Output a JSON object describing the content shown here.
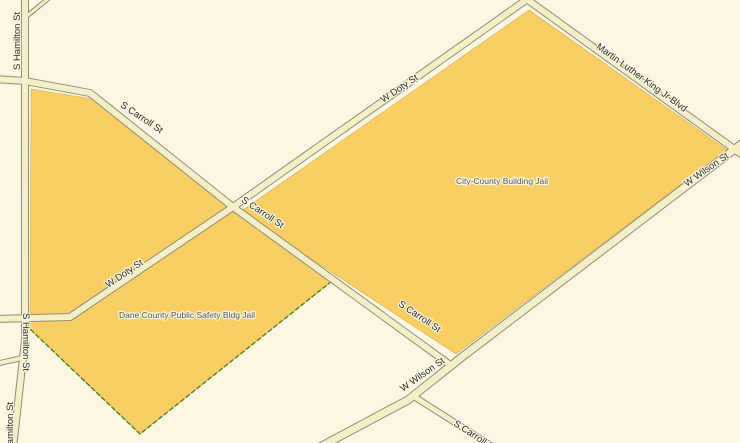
{
  "map": {
    "colors": {
      "background": "#FBF7E3",
      "street_fill": "#F4EFC6",
      "street_casing": "#8D8D7B",
      "parcel_fill": "#F9CE63",
      "parcel_dashed_border": "#4A8420",
      "street_label_color": "#2B2B28",
      "place_label_color": "#53544C"
    },
    "parcels": [
      {
        "name": "City-County Building Jail",
        "points": [
          [
            529,
            10
          ],
          [
            240,
            212
          ],
          [
            456,
            354
          ],
          [
            727,
            150
          ]
        ]
      },
      {
        "name": "Dane County Public Safety Bldg Jail",
        "points": [
          [
            31,
            89
          ],
          [
            93,
            99
          ],
          [
            236,
            212
          ],
          [
            332,
            281
          ],
          [
            140,
            434
          ],
          [
            30,
            329
          ]
        ]
      }
    ],
    "dashed_edges": [
      {
        "name": "dane-county-parcel-dashed-edge",
        "points": [
          [
            332,
            281
          ],
          [
            140,
            434
          ],
          [
            30,
            329
          ]
        ]
      }
    ],
    "streets": [
      {
        "name": "s-hamilton-st",
        "width": 6,
        "points": [
          [
            25,
            -5
          ],
          [
            25,
            340
          ],
          [
            13,
            448
          ]
        ]
      },
      {
        "name": "s-hamilton-stub-west",
        "width": 4,
        "points": [
          [
            22,
            358
          ],
          [
            -5,
            364
          ]
        ]
      },
      {
        "name": "top-left-fork",
        "width": 3,
        "points": [
          [
            27,
            16
          ],
          [
            54,
            -6
          ]
        ]
      },
      {
        "name": "s-carroll-st",
        "width": 6,
        "points": [
          [
            -5,
            79
          ],
          [
            25,
            81
          ],
          [
            90,
            93
          ],
          [
            233,
            207
          ],
          [
            453,
            367
          ]
        ]
      },
      {
        "name": "s-carroll-st-southeast",
        "width": 5,
        "points": [
          [
            413,
            396
          ],
          [
            495,
            448
          ]
        ]
      },
      {
        "name": "w-doty-st",
        "width": 6,
        "points": [
          [
            -5,
            319
          ],
          [
            70,
            317
          ],
          [
            233,
            207
          ],
          [
            543,
            -12
          ]
        ]
      },
      {
        "name": "martin-luther-king-jr-blvd",
        "width": 6,
        "points": [
          [
            514,
            -10
          ],
          [
            748,
            159
          ]
        ]
      },
      {
        "name": "w-wilson-st",
        "width": 7,
        "points": [
          [
            748,
            139
          ],
          [
            462,
            357
          ],
          [
            408,
            400
          ],
          [
            318,
            448
          ]
        ]
      }
    ],
    "labels": [
      {
        "name": "street-label-s-hamilton-st-top",
        "text": "S Hamilton St",
        "x": 20,
        "y": 41,
        "rot": -90,
        "anchor": "middle",
        "size": 9.5,
        "kind": "street"
      },
      {
        "name": "street-label-s-carroll-st-upper",
        "text": "S Carroll St",
        "x": 140,
        "y": 120,
        "rot": 34,
        "anchor": "middle",
        "size": 9.5,
        "kind": "street"
      },
      {
        "name": "street-label-w-doty-st-upper",
        "text": "W Doty St",
        "x": 401,
        "y": 91,
        "rot": -34,
        "anchor": "middle",
        "size": 9.5,
        "kind": "street"
      },
      {
        "name": "street-label-mlk-jr-blvd",
        "text": "Martin Luther King Jr Blvd",
        "x": 640,
        "y": 80,
        "rot": 36,
        "anchor": "middle",
        "size": 9.5,
        "kind": "street"
      },
      {
        "name": "place-label-city-county-building-jail",
        "text": "City-County Building Jail",
        "x": 502,
        "y": 184,
        "rot": 0,
        "anchor": "middle",
        "size": 8.5,
        "kind": "place"
      },
      {
        "name": "street-label-w-wilson-st-right",
        "text": "W Wilson St",
        "x": 708,
        "y": 172,
        "rot": -35,
        "anchor": "middle",
        "size": 9.5,
        "kind": "street"
      },
      {
        "name": "street-label-s-carroll-st-middle",
        "text": "S Carroll St",
        "x": 261,
        "y": 215,
        "rot": 34,
        "anchor": "middle",
        "size": 9.5,
        "kind": "street"
      },
      {
        "name": "street-label-w-doty-st-lower",
        "text": "W Doty St",
        "x": 126,
        "y": 276,
        "rot": -34,
        "anchor": "middle",
        "size": 9.5,
        "kind": "street"
      },
      {
        "name": "place-label-dane-county-public-safety-bldg-jail",
        "text": "Dane County Public Safety Bldg Jail",
        "x": 187,
        "y": 318,
        "rot": 0,
        "anchor": "middle",
        "size": 8.5,
        "kind": "place"
      },
      {
        "name": "street-label-s-carroll-st-lower",
        "text": "S Carroll St",
        "x": 418,
        "y": 319,
        "rot": 34,
        "anchor": "middle",
        "size": 9.5,
        "kind": "street"
      },
      {
        "name": "street-label-w-wilson-st-bottom",
        "text": "W Wilson St",
        "x": 424,
        "y": 377,
        "rot": -35,
        "anchor": "middle",
        "size": 9.5,
        "kind": "street"
      },
      {
        "name": "street-label-s-carroll-st-bottom-clipped",
        "text": "S Carroll St",
        "x": 453,
        "y": 425,
        "rot": 33,
        "anchor": "start",
        "size": 9.5,
        "kind": "street"
      },
      {
        "name": "street-label-s-hamilton-st-middle",
        "text": "S Hamilton St",
        "x": 23,
        "y": 342,
        "rot": 90,
        "anchor": "middle",
        "size": 9.5,
        "kind": "street"
      },
      {
        "name": "street-label-s-hamilton-st-bottom-clipped",
        "text": "S Hamilton St",
        "x": 13,
        "y": 431,
        "rot": -90,
        "anchor": "middle",
        "size": 9.5,
        "kind": "street"
      }
    ]
  }
}
